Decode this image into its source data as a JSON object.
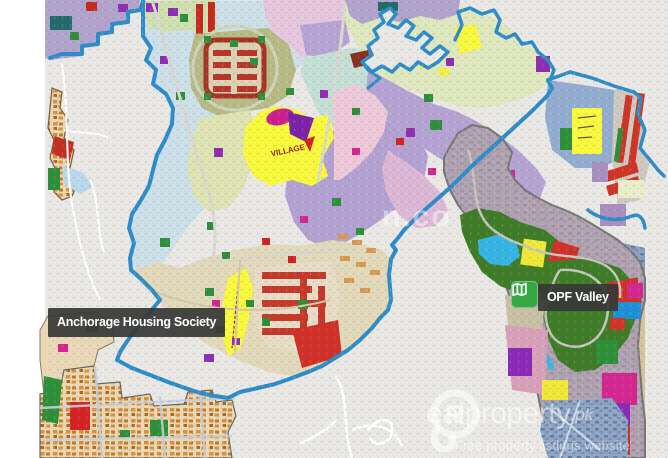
{
  "page": {
    "width": 668,
    "height": 458
  },
  "map": {
    "markers": [
      {
        "id": "anchorage",
        "label": "Anchorage Housing Society"
      },
      {
        "id": "opf",
        "label": "OPF Valley"
      }
    ],
    "parcel_labels": {
      "village": "VILLAGE"
    },
    "watermarks": {
      "center_fragment": "n.co",
      "brand_initial": "R",
      "brand_rest": "ealproperty",
      "brand_tld": ".pk",
      "tagline": "Free property listings website"
    },
    "colors": {
      "society_border": "#2e8cc8",
      "map_background": "#e9e8e5",
      "page_margin": "#ffffff",
      "marker_background": "#383838",
      "opf_icon_green": "#35a845",
      "parcel_yellow": "#f8f83c",
      "parcel_red": "#cf3526",
      "parcel_green": "#2e8f3a",
      "parcel_purple": "#8d2fb0",
      "parcel_magenta": "#d4268f"
    }
  }
}
